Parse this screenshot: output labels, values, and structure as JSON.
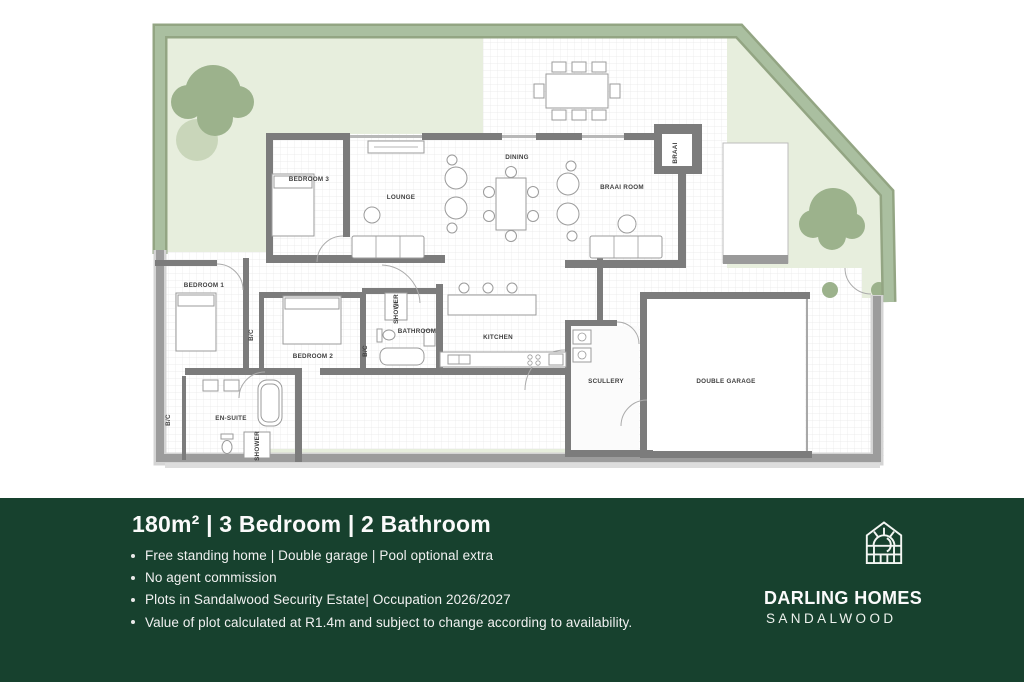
{
  "banner": {
    "title": "180m² | 3 Bedroom | 2 Bathroom",
    "bullets": [
      "Free standing home | Double garage | Pool optional extra",
      "No agent commission",
      "Plots in Sandalwood Security Estate| Occupation 2026/2027",
      "Value of plot calculated at R1.4m and subject to change according to availability."
    ],
    "brand": {
      "name": "DARLING HOMES",
      "sub": "SANDALWOOD"
    },
    "colors": {
      "background": "#17412e",
      "text": "#f5f5f5"
    }
  },
  "plan": {
    "rooms": {
      "bedroom1": "BEDROOM 1",
      "bedroom2": "BEDROOM 2",
      "bedroom3": "BEDROOM 3",
      "lounge": "LOUNGE",
      "dining": "DINING",
      "braai_room": "BRAAI ROOM",
      "braai": "BRAAI",
      "kitchen": "KITCHEN",
      "bathroom": "BATHROOM",
      "shower": "SHOWER",
      "ensuite": "EN-SUITE",
      "bc": "B/C",
      "scullery": "SCULLERY",
      "garage": "DOUBLE GARAGE"
    },
    "colors": {
      "garden_border": "#aabfa0",
      "garden_border_shade": "#93a583",
      "lawn": "#e7eedd",
      "tree": "#9cb28c",
      "tree_light": "#c9d6ba",
      "wall": "#7c7c7c",
      "plot_wall": "#9c9c9c",
      "floor_grid": "#e8e8e8"
    }
  }
}
